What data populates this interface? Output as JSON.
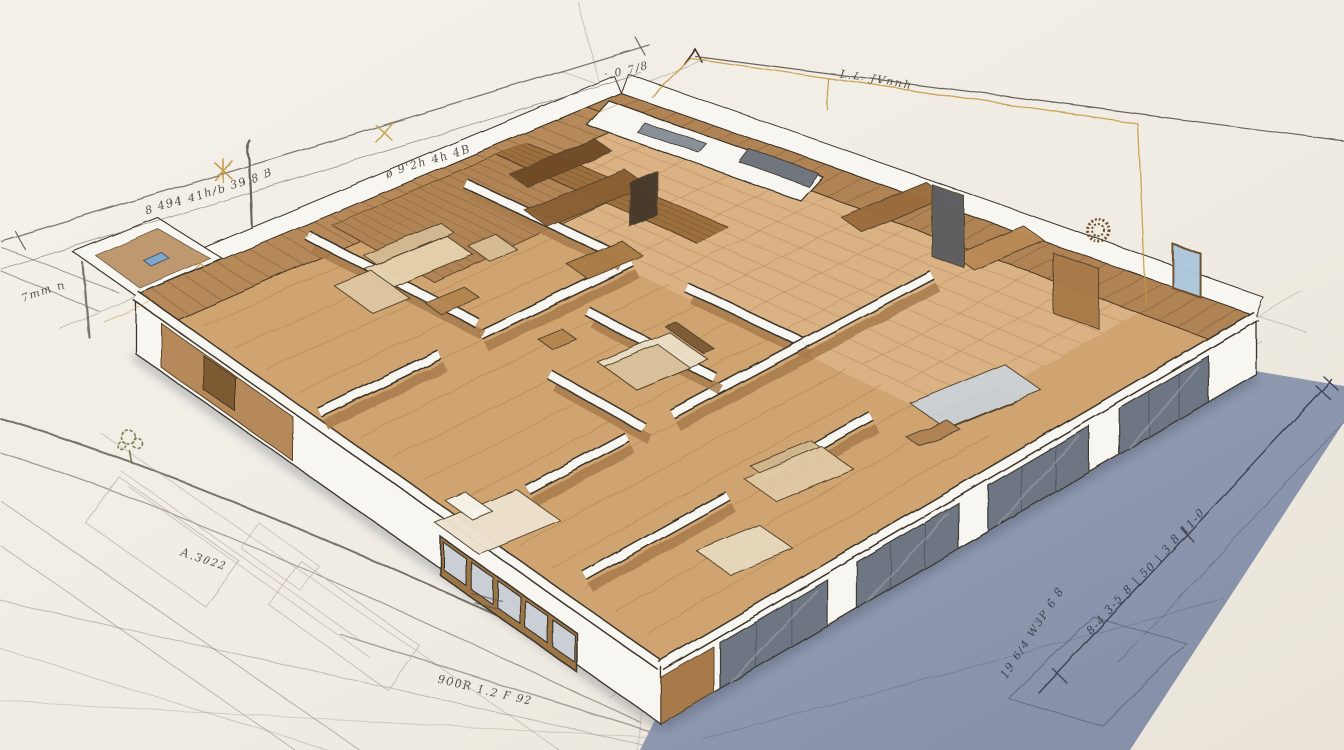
{
  "scene": {
    "type": "isometric-architectural-floorplan-sketch",
    "background": "#f2efe8",
    "background_edge": "#e9e3d7",
    "cast_shadow": "#8d97ae",
    "ink": "#3b342c",
    "graphite": "#6a645c",
    "gold_guide": "#c2963f",
    "wall_white": "#f8f6f1",
    "wood_wall": "#b5895a",
    "wood_dark": "#7c5a33",
    "wood_floor": "#cfa46f",
    "wood_floor_light": "#dcb486",
    "glass_panel": "#6e7683",
    "window_pane": "#c9cfd5",
    "plant_green": "#76804f",
    "annotation_ink": "#57514a"
  },
  "annotations": [
    {
      "name": "note-top-left-far",
      "text": "8 494 41h/b 39.8 B"
    },
    {
      "name": "note-top-left",
      "text": "ø 9'2h  4h 4B"
    },
    {
      "name": "note-top-left-small",
      "text": "· 0 7/8"
    },
    {
      "name": "note-top-right",
      "text": "L.L. JVnnh"
    },
    {
      "name": "note-left-edge",
      "text": "7mm n"
    },
    {
      "name": "note-sketch-left",
      "text": "A.3022"
    },
    {
      "name": "note-sketch-front",
      "text": "900R 1.2 F 92"
    },
    {
      "name": "note-shadow-right",
      "text": "8-4 3-5 8 | 50 | 3 8 11-0"
    },
    {
      "name": "note-shadow-bottom",
      "text": "19 6/4 W3P 6 8"
    }
  ]
}
